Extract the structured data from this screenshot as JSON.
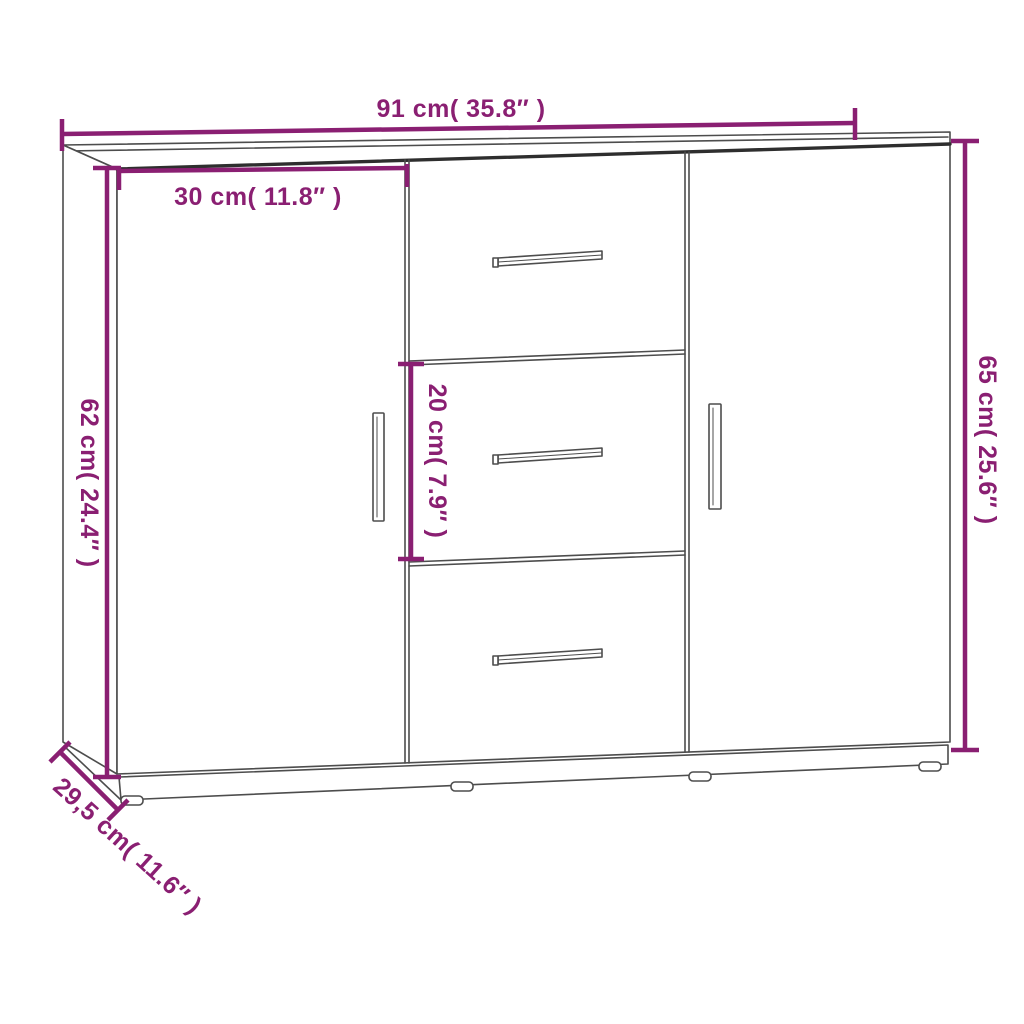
{
  "diagram": {
    "product": "sideboard with two doors and three middle drawers",
    "background_color": "#ffffff",
    "accent_color": "#8A1F72",
    "outline_color": "#4D4D4D",
    "dimensions": {
      "total_width": {
        "label": "91 cm( 35.8″ )",
        "cm": "91",
        "inch": "35.8"
      },
      "left_door_width": {
        "label": "30 cm( 11.8″ )",
        "cm": "30",
        "inch": "11.8"
      },
      "body_height": {
        "label": "62 cm( 24.4″ )",
        "cm": "62",
        "inch": "24.4"
      },
      "total_height": {
        "label": "65 cm( 25.6″ )",
        "cm": "65",
        "inch": "25.6"
      },
      "middle_drawer_height": {
        "label": "20 cm( 7.9″ )",
        "cm": "20",
        "inch": "7.9"
      },
      "depth": {
        "label": "29,5 cm( 11.6″ )",
        "cm": "29,5",
        "inch": "11.6"
      }
    }
  }
}
